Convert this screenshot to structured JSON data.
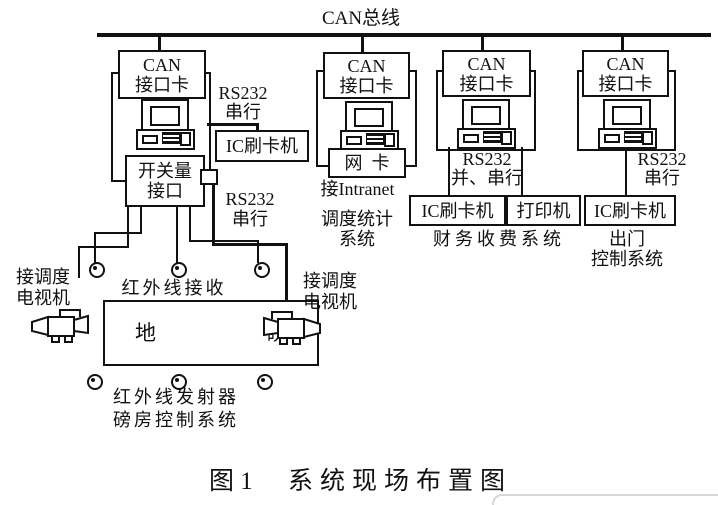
{
  "bus": {
    "label": "CAN总线"
  },
  "branches": {
    "b1": {
      "card": {
        "line1": "CAN",
        "line2": "接口卡"
      },
      "rs232_top": {
        "line1": "RS232",
        "line2": "串行"
      },
      "ic_reader": "IC刷卡机",
      "switch_io": {
        "line1": "开关量",
        "line2": "接口"
      },
      "rs232_bottom": {
        "line1": "RS232",
        "line2": "串行"
      }
    },
    "b2": {
      "card": {
        "line1": "CAN",
        "line2": "接口卡"
      },
      "net_card": "网  卡",
      "intranet": "接Intranet",
      "system": {
        "line1": "调度统计",
        "line2": "系统"
      }
    },
    "b3": {
      "card": {
        "line1": "CAN",
        "line2": "接口卡"
      },
      "rs232": {
        "line1": "RS232",
        "line2": "并、串行"
      },
      "ic_reader": "IC刷卡机",
      "printer": "打印机",
      "system": "财务收费系统"
    },
    "b4": {
      "card": {
        "line1": "CAN",
        "line2": "接口卡"
      },
      "rs232": {
        "line1": "RS232",
        "line2": "串行"
      },
      "ic_reader": "IC刷卡机",
      "system": {
        "line1": "出门",
        "line2": "控制系统"
      }
    }
  },
  "site": {
    "tv_left": {
      "line1": "接调度",
      "line2": "电视机"
    },
    "tv_right": {
      "line1": "接调度",
      "line2": "电视机"
    },
    "ir_receiver": "红外线接收",
    "weighbridge": {
      "char1": "地",
      "char2": "磅"
    },
    "ir_transmitter": "红外线发射器",
    "weigh_room_system": "磅房控制系统"
  },
  "caption": {
    "prefix": "图 1",
    "text": "系统现场布置图"
  },
  "colors": {
    "line": "#111111",
    "background": "#ffffff",
    "panel_edge": "#d8d8d8"
  }
}
